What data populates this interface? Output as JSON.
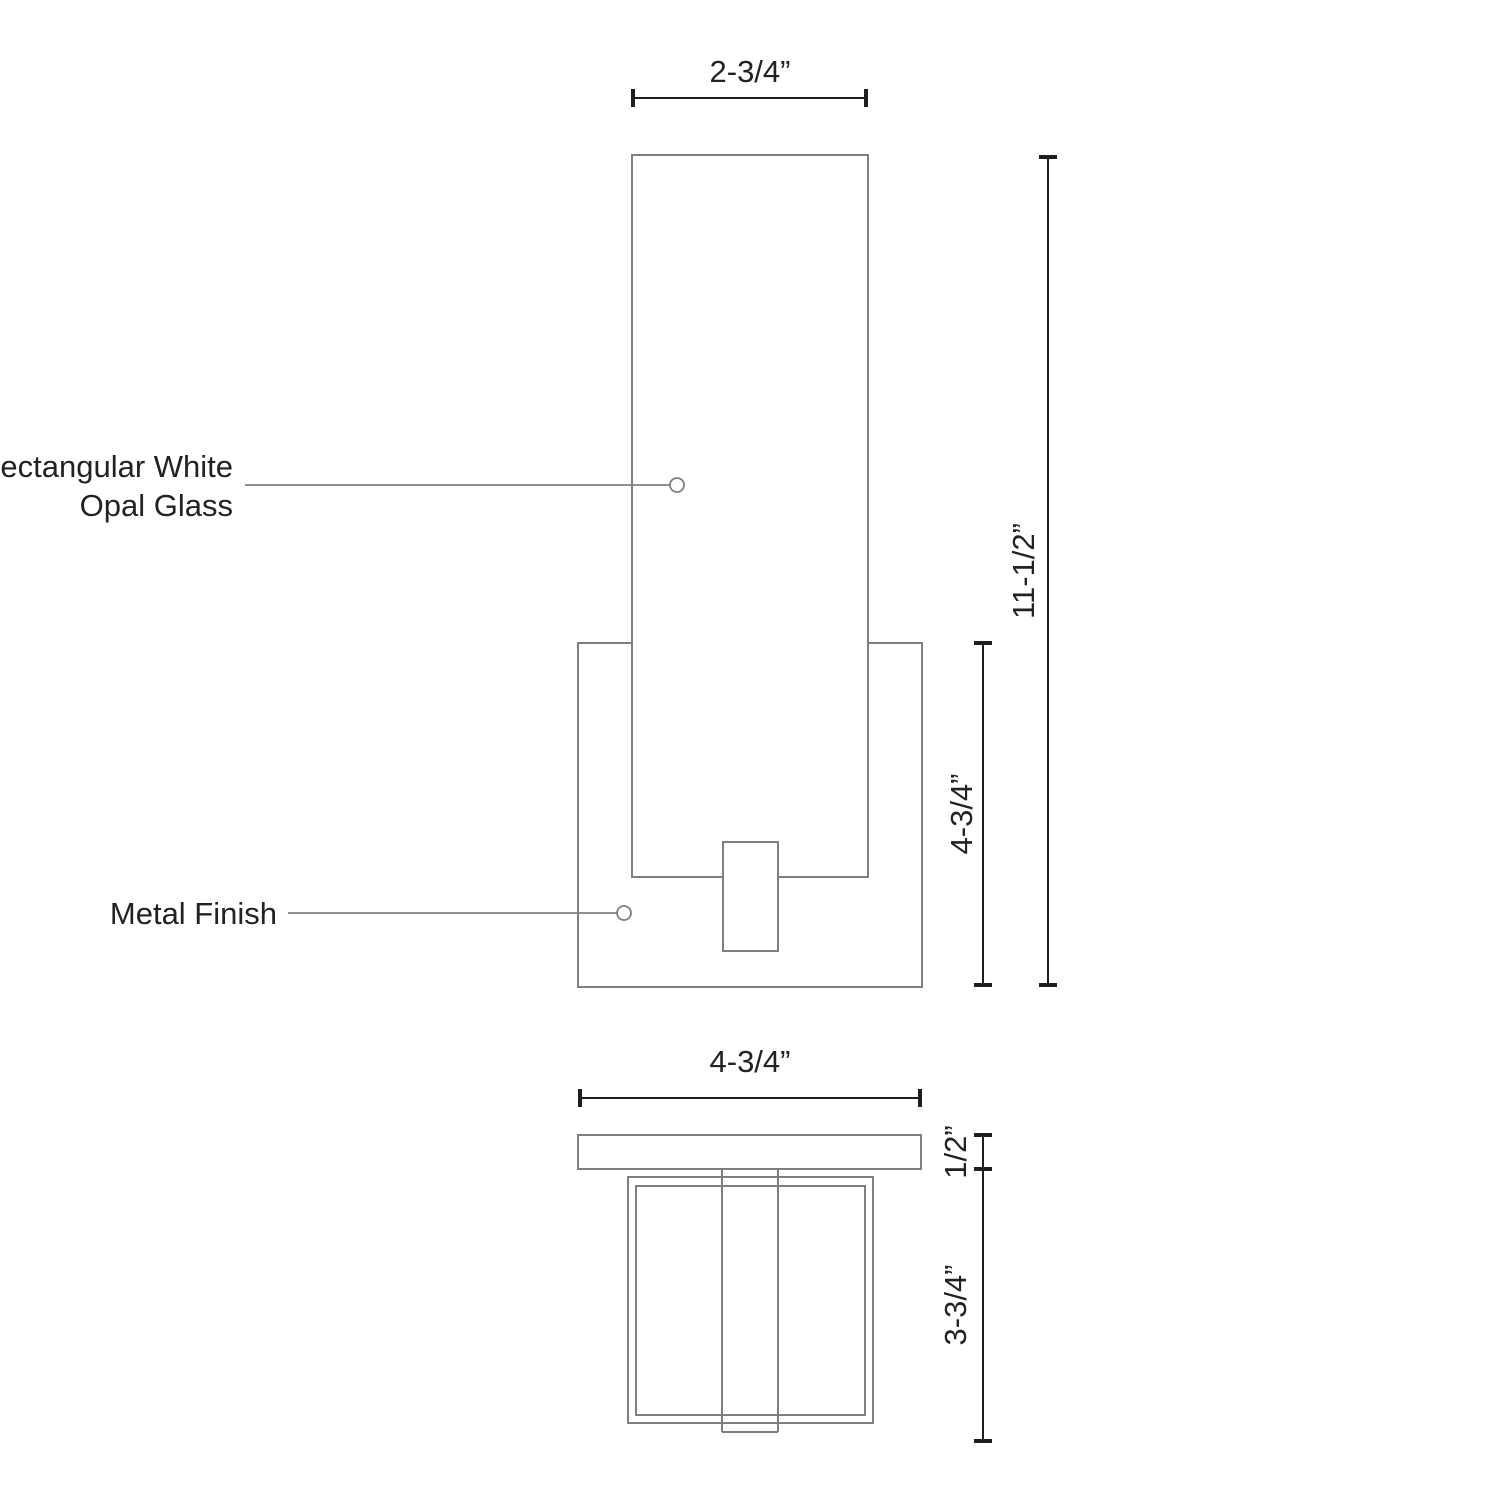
{
  "front_view": {
    "labels": {
      "glass_label_line1": "Rectangular White",
      "glass_label_line2": "Opal Glass",
      "metal_label": "Metal Finish"
    },
    "dimensions": {
      "glass_width": "2-3/4”",
      "overall_height": "11-1/2”",
      "backplate_height": "4-3/4”"
    }
  },
  "top_view": {
    "dimensions": {
      "overall_width": "4-3/4”",
      "plate_depth": "1/2”",
      "body_depth": "3-3/4”"
    }
  },
  "colors": {
    "background": "#ffffff",
    "outline": "#7f7f7f",
    "dimension_line": "#1f1f1f",
    "text": "#222222"
  }
}
